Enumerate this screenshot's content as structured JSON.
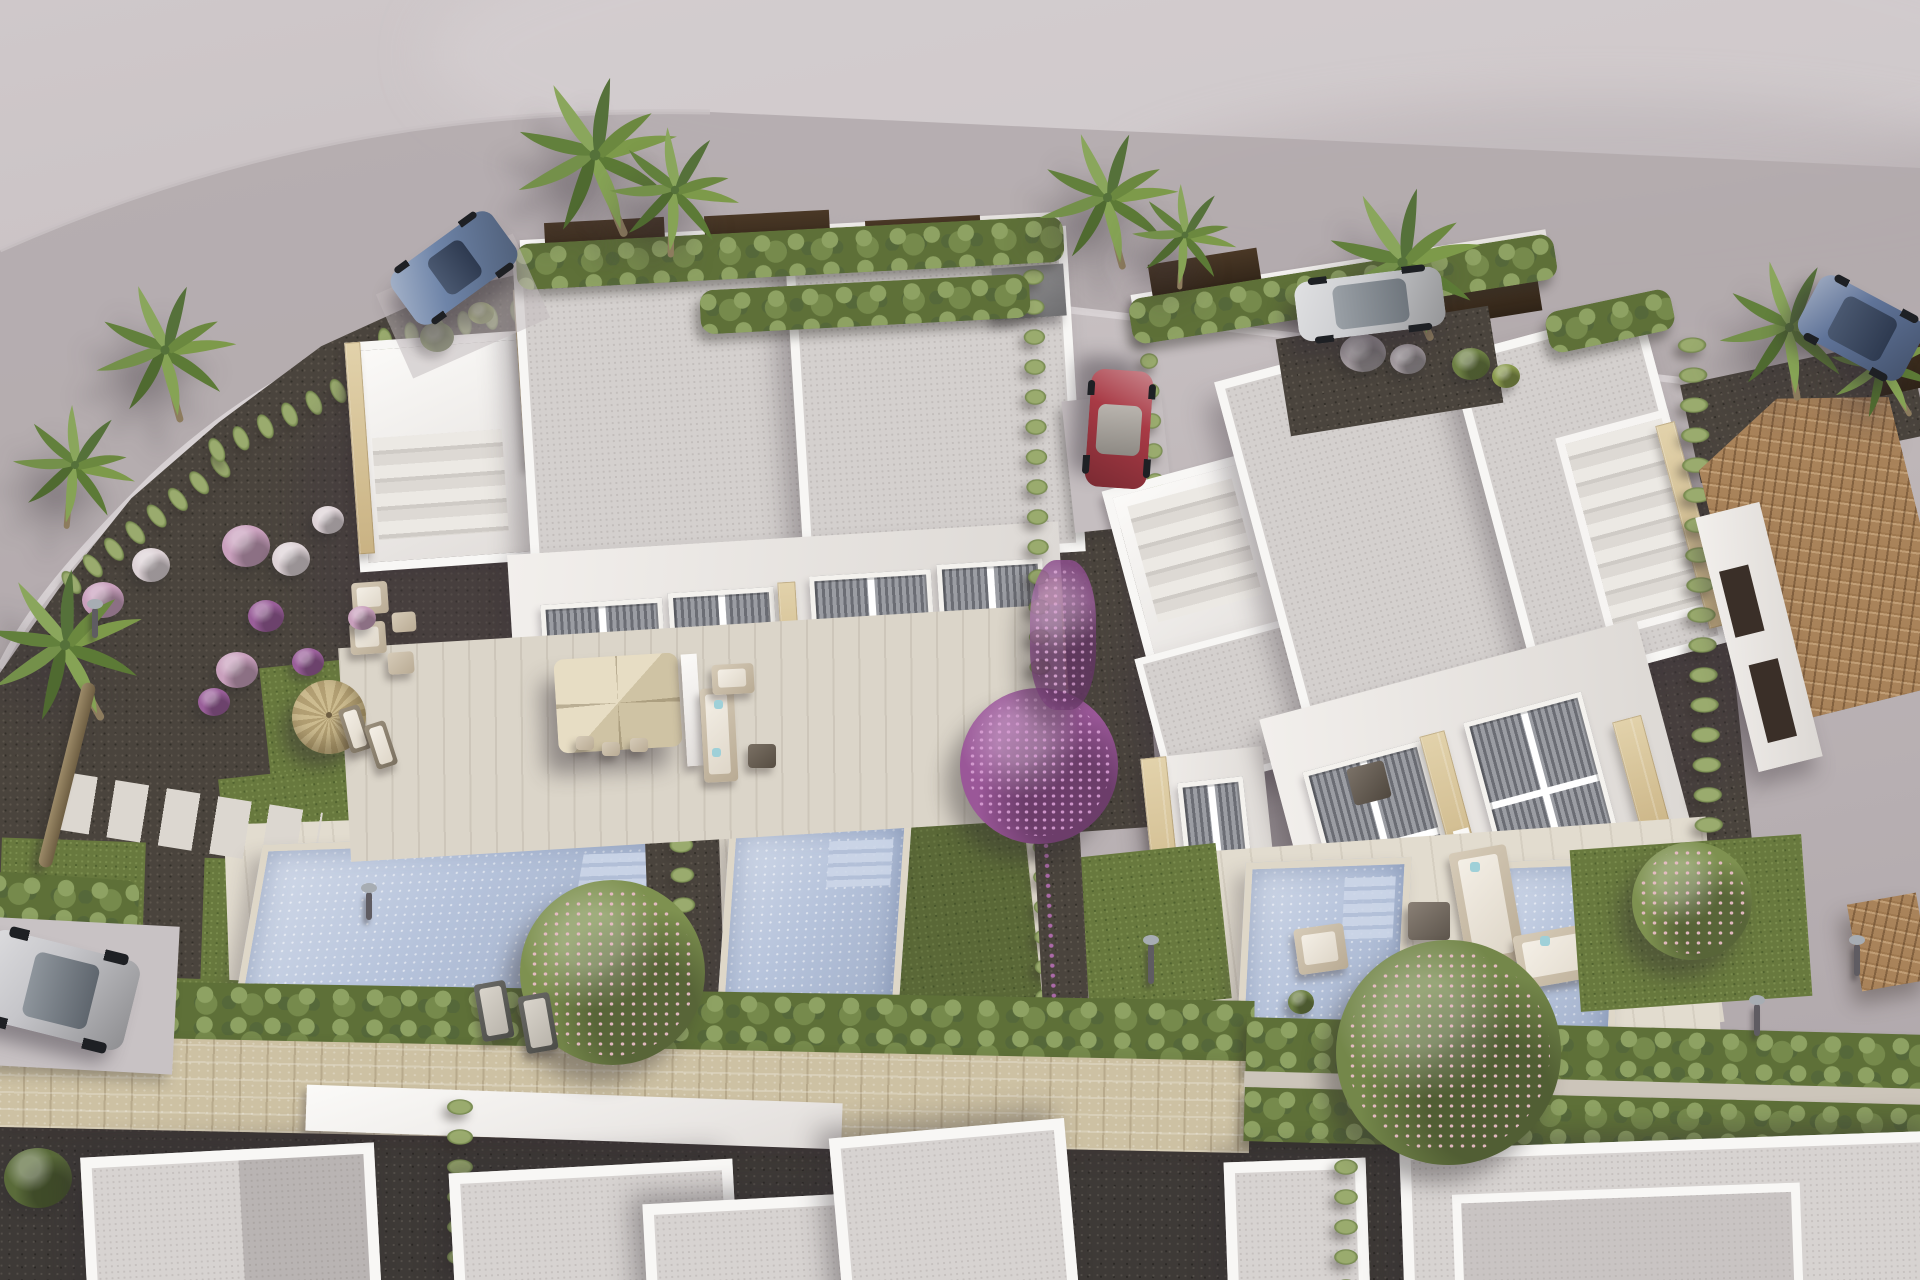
{
  "meta": {
    "type": "3d-architectural-render",
    "view": "aerial-oblique",
    "subject": "new-build residential development of modern white duplex villas with private pools and gardens",
    "text_visible": "none"
  },
  "palette": {
    "ground_light": "#c8c1c3",
    "ground_shadow": "#8e8692",
    "road": "#b1a9ab",
    "curb": "#dad4d6",
    "gravel": "#4a443d",
    "asphalt": "#3e3a37",
    "lawn": "#68793e",
    "hedge": "#5e7038",
    "cypress": "#71854a",
    "pool": "#b6c3db",
    "pool_coping": "#ded7c8",
    "deck": "#dbd5c9",
    "white_wall": "#f6f4f2",
    "roof_grey": "#d4d0ce",
    "travertine": "#d5c294",
    "stone_wall": "#cdc1a3",
    "terracotta": "#a9835a",
    "fence_brown": "#43331f",
    "blinds": "#71737a",
    "parasol": "#dfd4b8",
    "straw_umbrella": "#c4b287",
    "bougainvillea": "#9a5798",
    "blossom_pink": "#e3bcc6",
    "palm_green": "#6f8c3f",
    "trunk_brown": "#8d7c5e",
    "car_blue": "#6e84a8",
    "car_red": "#a83a45",
    "car_silver_suv": "#cdced1",
    "car_navy": "#5f7398",
    "car_silver": "#c6c6ca",
    "cushion_aqua": "#9fd0d8",
    "bush_pink": "#c9a0bd",
    "bush_white": "#ddd2d6",
    "bush_purple": "#9a5f9a",
    "bush_green": "#6d8044",
    "bush_grey": "#a8a0a4",
    "tree_green": "#7e9150",
    "tree_purple": "#9a5798"
  },
  "scene": {
    "buildings": [
      {
        "id": "left-duplex-villa",
        "style": "modern flat-roof white render",
        "units": 2,
        "features": [
          "roof terraces with external stairs",
          "travertine stone trim",
          "full-height glazing with grey blinds",
          "rooftop AC units",
          "cream paved terrace"
        ]
      },
      {
        "id": "right-duplex-villa",
        "style": "modern flat-roof white render",
        "units": 2,
        "features": [
          "roof-access stair towers",
          "travertine stone trim",
          "tall glazed facades with grey blinds",
          "rooftop AC unit",
          "cream paved terrace"
        ]
      },
      {
        "id": "terracotta-roof-house",
        "style": "existing neighbour house with hipped clay-tile roof",
        "units": 1,
        "features": [
          "white walls",
          "dark window recesses"
        ]
      },
      {
        "id": "foreground-villa-row",
        "style": "modern flat-roof white render",
        "units": 6,
        "features": [
          "only parapet rooftops visible at bottom edge"
        ]
      }
    ],
    "pools": [
      {
        "owner": "left-duplex-unit-a",
        "shape": "large rectangle",
        "has_steps": true
      },
      {
        "owner": "left-duplex-unit-b",
        "shape": "narrow rectangle",
        "has_steps": true
      },
      {
        "owner": "right-duplex-unit-a",
        "shape": "rectangle with corner steps",
        "has_steps": true
      },
      {
        "owner": "right-duplex-unit-b",
        "shape": "rectangle partly hidden by tree",
        "has_steps": false
      }
    ],
    "vehicles": [
      {
        "id": "blue-convertible-coupe",
        "location": "top-left road",
        "color_key": "car_blue"
      },
      {
        "id": "red-hatchback",
        "location": "driveway between villas",
        "color_key": "car_red"
      },
      {
        "id": "silver-white-suv",
        "location": "road top-right",
        "color_key": "car_silver_suv"
      },
      {
        "id": "navy-suv",
        "location": "far right road edge",
        "color_key": "car_navy"
      },
      {
        "id": "silver-hatchback",
        "location": "bottom-left parking bay",
        "color_key": "car_silver"
      }
    ],
    "vegetation": {
      "palm_trees": 10,
      "cypress_hedge_rows": "along plot boundaries, street wall and between gardens",
      "flowering_plants": [
        "purple bougainvillea tree and climbers",
        "pink-blossom garden trees",
        "pink/white/purple flower bushes",
        "grey ornamental grass balls"
      ],
      "lawn_patches": 9
    },
    "amenities": [
      "cream cantilever parasol with dining set",
      "straw garden umbrella with loungers",
      "outdoor wicker sofa sets with aqua cushions",
      "sun loungers on lawn",
      "stepping-stone paths",
      "garden lamps",
      "outdoor shower",
      "cream stone street wall"
    ]
  }
}
